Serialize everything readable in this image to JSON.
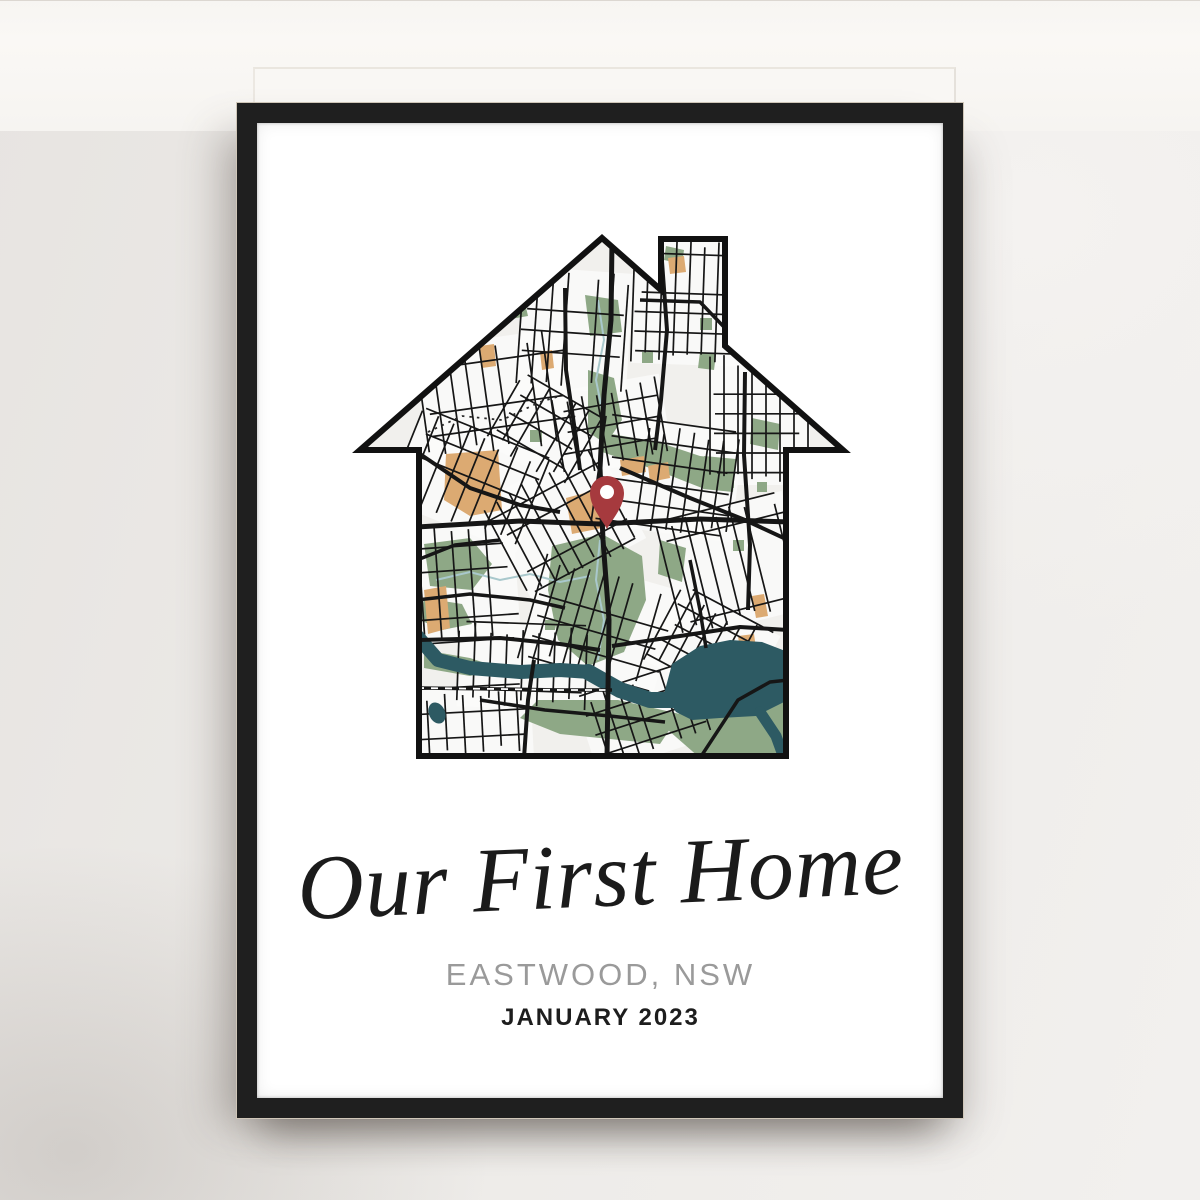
{
  "poster": {
    "title": "Our First Home",
    "location": "EASTWOOD, NSW",
    "date": "JANUARY 2023"
  },
  "map": {
    "pin_color": "#a63a3e",
    "pin_hole_color": "#ffffff",
    "water_color": "#2d5a63",
    "creek_color": "#a9c8cc",
    "park_color": "#8ea886",
    "sand_color": "#dcaa72",
    "street_color": "#161616",
    "background_color": "#f1f0ed",
    "block_color": "#fbfbfa",
    "outline_color": "#111111"
  },
  "frame": {
    "color": "#1f1f1f"
  },
  "wall": {
    "color": "#eae8e5"
  },
  "ledge": {
    "color": "#f8f6f3"
  }
}
